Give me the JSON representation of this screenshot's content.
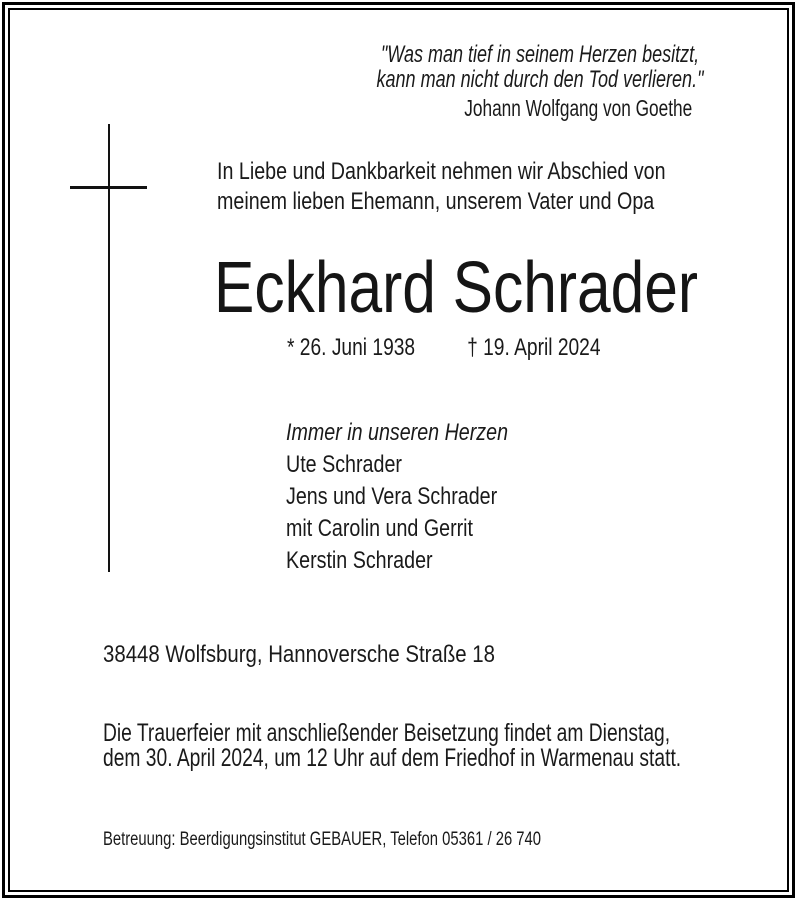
{
  "notice": {
    "quote": {
      "line1": "\"Was man tief in seinem Herzen besitzt,",
      "line2": "kann man nicht durch den Tod verlieren.\"",
      "attribution": "Johann Wolfgang von Goethe"
    },
    "intro": {
      "line1": "In Liebe und Dankbarkeit nehmen wir Abschied von",
      "line2": "meinem lieben Ehemann, unserem Vater und Opa"
    },
    "deceased": {
      "name": "Eckhard Schrader",
      "birth_date": "* 26. Juni 1938",
      "death_date": "† 19. April 2024"
    },
    "mourning": {
      "lead": "Immer in unseren Herzen",
      "names": [
        "Ute Schrader",
        "Jens und Vera Schrader",
        "mit Carolin und Gerrit",
        "Kerstin Schrader"
      ]
    },
    "address": "38448 Wolfsburg, Hannoversche Straße 18",
    "funeral": {
      "line1": "Die Trauerfeier mit anschließender Beisetzung findet am Dienstag,",
      "line2": "dem 30. April 2024, um 12 Uhr auf dem Friedhof in Warmenau statt."
    },
    "care_line": "Betreuung: Beerdigungsinstitut GEBAUER, Telefon 05361 / 26 740"
  },
  "colors": {
    "background": "#ffffff",
    "text": "#1a1a1a",
    "frame": "#000000"
  }
}
